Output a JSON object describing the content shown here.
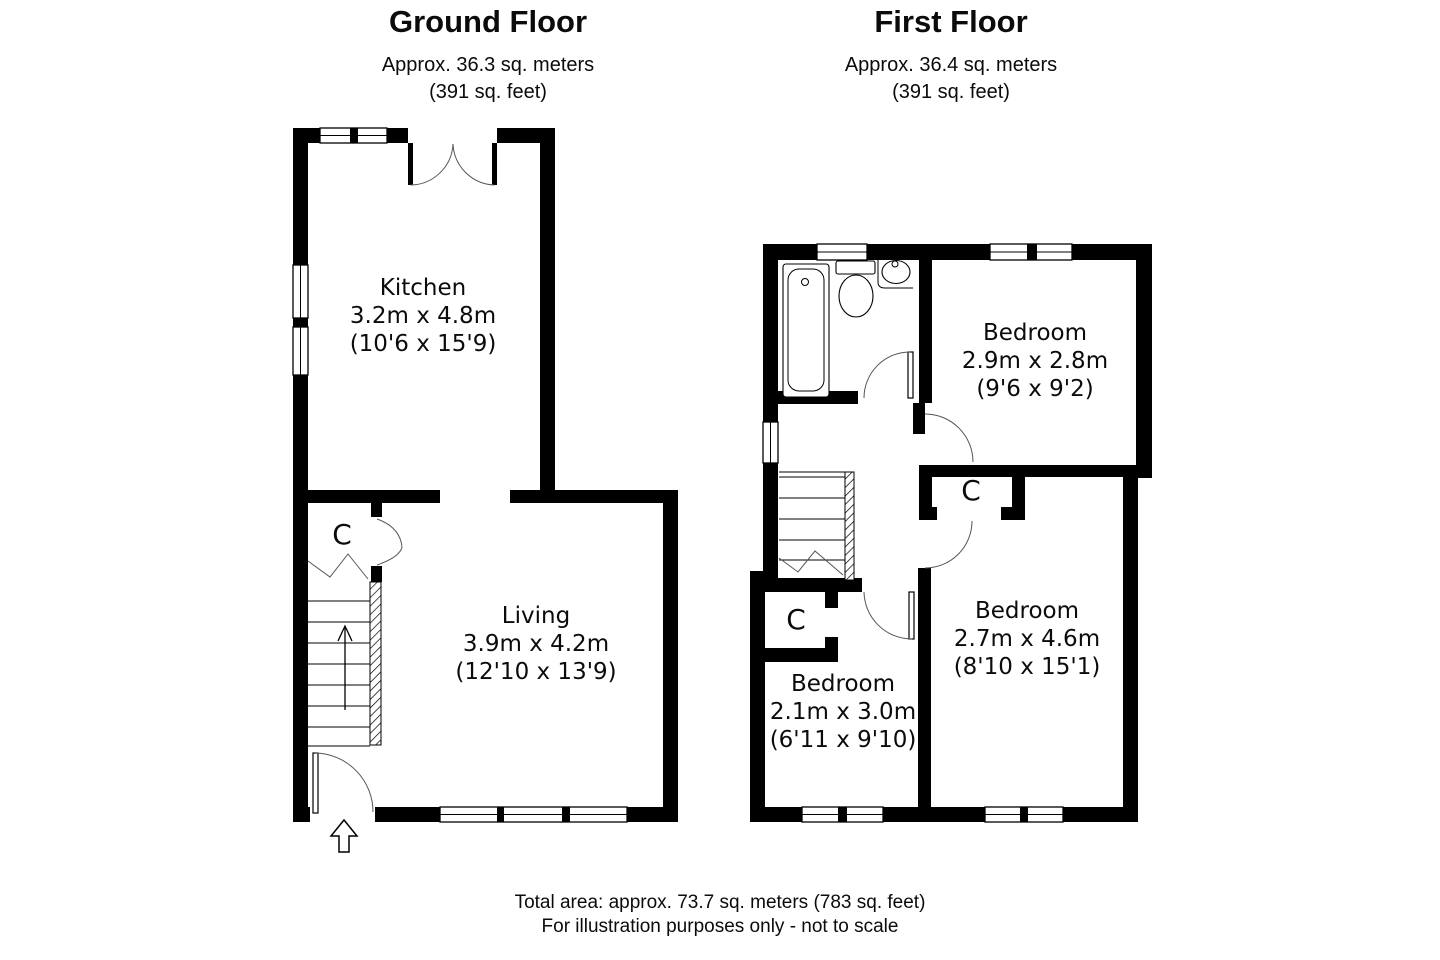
{
  "ground_floor": {
    "title": "Ground Floor",
    "area_metric": "Approx. 36.3 sq. meters",
    "area_imperial": "(391 sq. feet)",
    "kitchen": {
      "name": "Kitchen",
      "metric": "3.2m x 4.8m",
      "imperial": "(10'6 x 15'9)"
    },
    "living": {
      "name": "Living",
      "metric": "3.9m x 4.2m",
      "imperial": "(12'10 x 13'9)"
    },
    "closet_label": "C"
  },
  "first_floor": {
    "title": "First Floor",
    "area_metric": "Approx. 36.4 sq. meters",
    "area_imperial": "(391 sq. feet)",
    "bedroom_top": {
      "name": "Bedroom",
      "metric": "2.9m x 2.8m",
      "imperial": "(9'6 x 9'2)"
    },
    "bedroom_right": {
      "name": "Bedroom",
      "metric": "2.7m x 4.6m",
      "imperial": "(8'10 x 15'1)"
    },
    "bedroom_left": {
      "name": "Bedroom",
      "metric": "2.1m x 3.0m",
      "imperial": "(6'11 x 9'10)"
    },
    "closet_upper_label": "C",
    "closet_lower_label": "C"
  },
  "footer": {
    "line1": "Total area: approx. 73.7 sq. meters (783 sq. feet)",
    "line2": "For illustration purposes only - not to scale"
  },
  "colors": {
    "wall": "#000000",
    "background": "#ffffff",
    "swing_line": "#555555"
  }
}
